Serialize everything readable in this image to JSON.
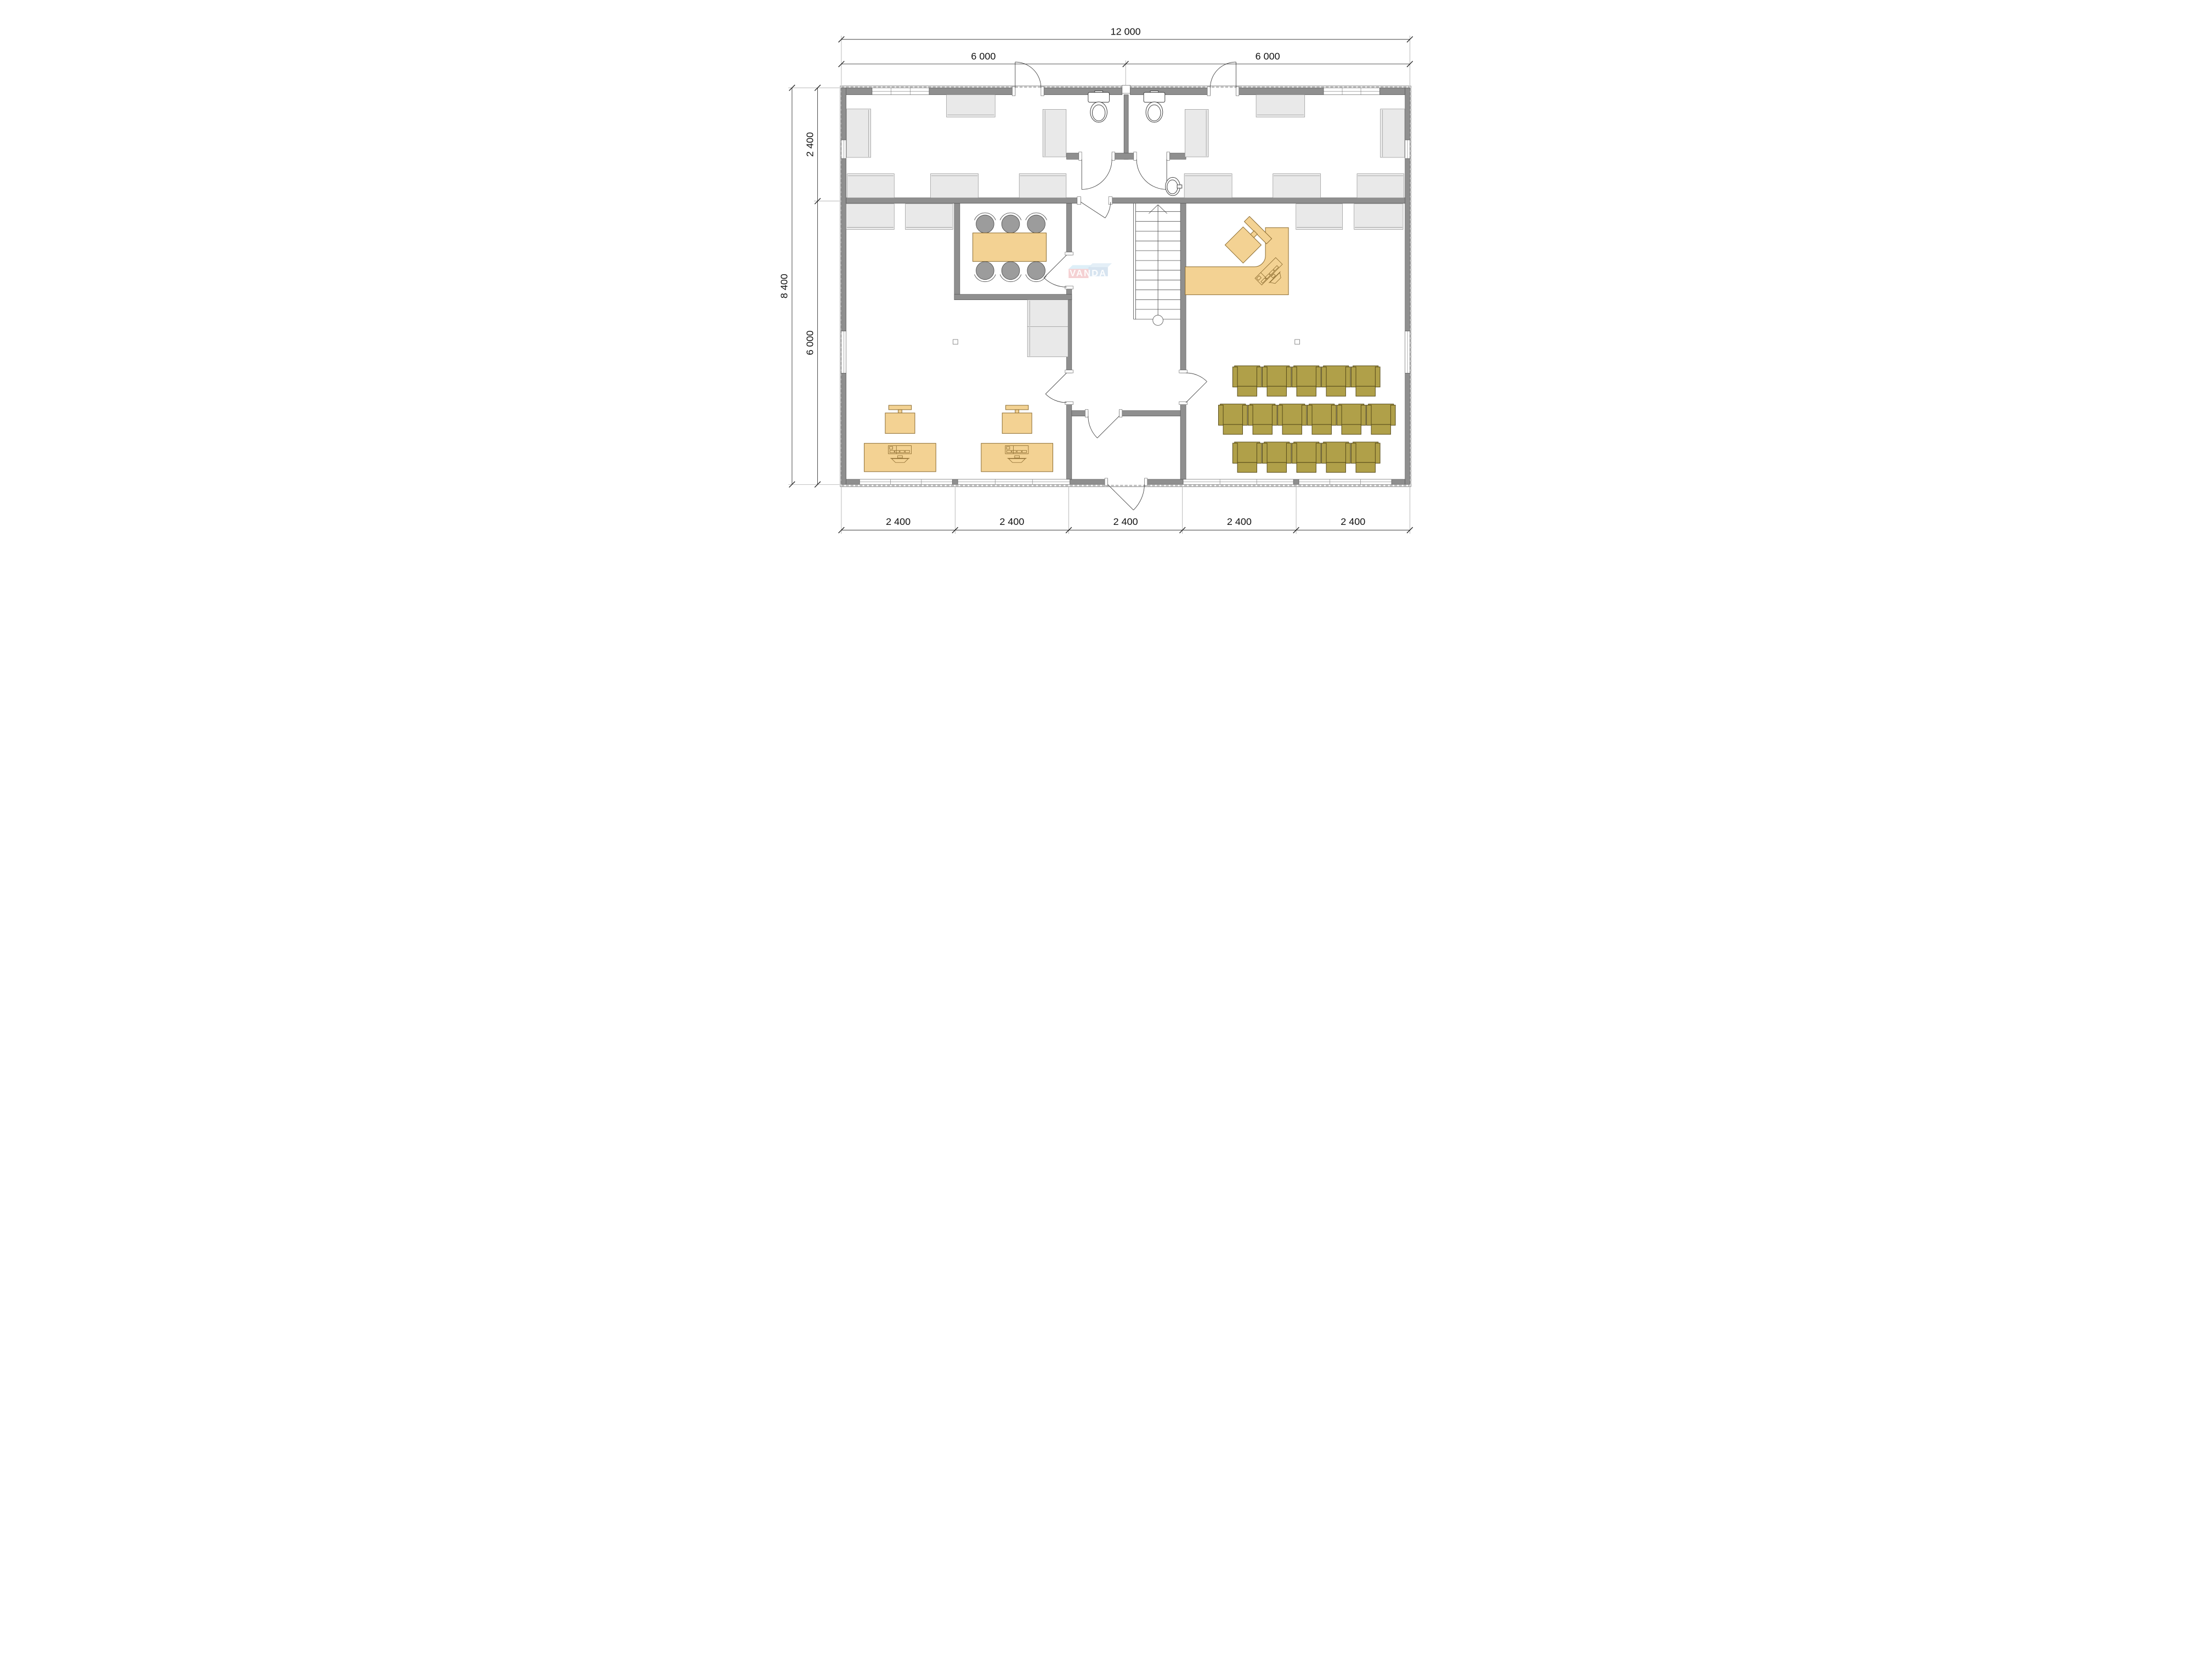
{
  "plan": {
    "type": "office floor plan",
    "watermark": {
      "text": "VANDA"
    },
    "dimensions": {
      "top_total": "12 000",
      "top_left": "6 000",
      "top_right": "6 000",
      "left_total": "8 400",
      "left_upper": "2 400",
      "left_lower": "6 000",
      "bottom": [
        "2 400",
        "2 400",
        "2 400",
        "2 400",
        "2 400"
      ]
    },
    "furniture": {
      "auditorium_rows": [
        5,
        6,
        5
      ],
      "conference_seats": 6,
      "workstation_desks": 2,
      "reception_desks": 1,
      "toilets": 2,
      "sinks": 1,
      "staircases": 1
    },
    "colors": {
      "wall": "#8f8f8f",
      "wall_stroke": "#545454",
      "cabinet": "#e9e9e9",
      "cabinet_stroke": "#8c8c8c",
      "wood": "#f3d293",
      "wood_stroke": "#8a6a2e",
      "olive": "#b0a049",
      "olive_stroke": "#544818",
      "chair_gray": "#9c9c9c",
      "dim_text": "#111111",
      "wm_pink": "#f3c9cb",
      "wm_blue_top": "#d8ecf7",
      "wm_blue": "#cdddec",
      "wm_blue_top2": "#ddebf5",
      "wm_text": "#ffffff"
    }
  }
}
